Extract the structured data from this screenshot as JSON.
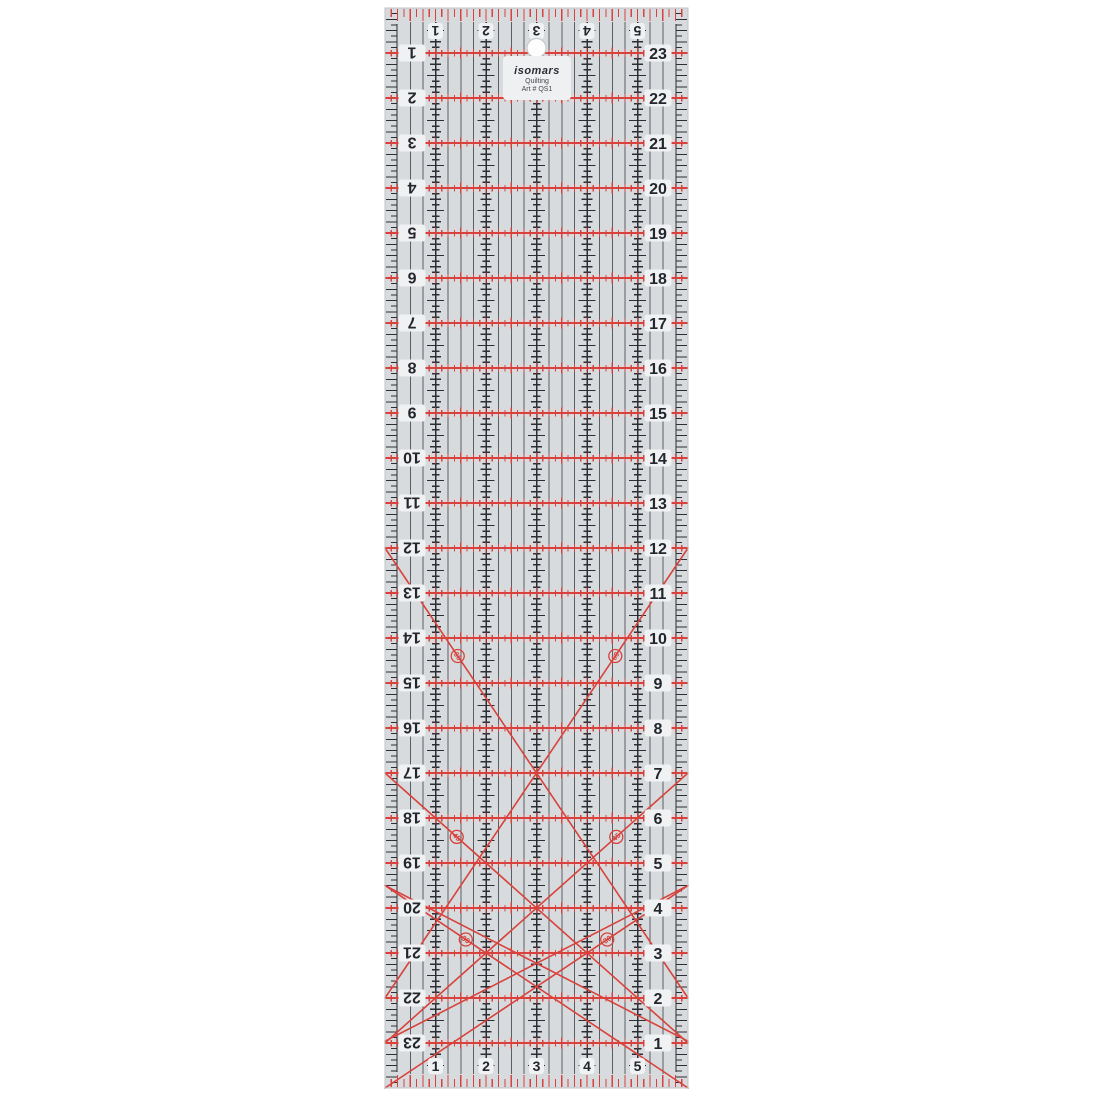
{
  "product": {
    "brand": "isomars",
    "line1": "Quilting",
    "line2": "Art # QS1"
  },
  "ruler": {
    "width_inches": 6,
    "length_inches": 24,
    "scales": {
      "top": [
        "1",
        "2",
        "3",
        "4",
        "5"
      ],
      "bottom": [
        "5",
        "4",
        "3",
        "2",
        "1"
      ],
      "left": [
        "1",
        "2",
        "3",
        "4",
        "5",
        "6",
        "7",
        "8",
        "9",
        "10",
        "11",
        "12",
        "13",
        "14",
        "15",
        "16",
        "17",
        "18",
        "19",
        "20",
        "21",
        "22",
        "23"
      ],
      "right": [
        "23",
        "22",
        "21",
        "20",
        "19",
        "18",
        "17",
        "16",
        "15",
        "14",
        "13",
        "12",
        "11",
        "10",
        "9",
        "8",
        "7",
        "6",
        "5",
        "4",
        "3",
        "2",
        "1"
      ]
    },
    "angle_labels": [
      "60",
      "45",
      "30"
    ],
    "colors": {
      "page_bg": "#ffffff",
      "body": "#d8dbdd",
      "grid_black": "#2b2e34",
      "grid_light": "#5a5e64",
      "red": "#d9423c",
      "halo": "#eff1f2",
      "number": "#23262c",
      "edge": "#bfc3c6",
      "hole_fill": "#fdfdfd",
      "hole_ring": "#c7cacd"
    },
    "geometry": {
      "left": 385,
      "top": 8,
      "ppi_x": 50.5,
      "ppi_y": 45
    },
    "diagonals": [
      {
        "angle": "60",
        "a": [
          0,
          12
        ],
        "b": [
          6,
          22
        ]
      },
      {
        "angle": "60",
        "a": [
          6,
          12
        ],
        "b": [
          0,
          22
        ]
      },
      {
        "angle": "45",
        "a": [
          0,
          17
        ],
        "b": [
          6,
          23
        ]
      },
      {
        "angle": "45",
        "a": [
          6,
          17
        ],
        "b": [
          0,
          23
        ]
      },
      {
        "angle": "30",
        "a": [
          0,
          19.5
        ],
        "b": [
          6,
          22.96
        ]
      },
      {
        "angle": "30",
        "a": [
          6,
          19.5
        ],
        "b": [
          0,
          22.96
        ]
      },
      {
        "angle": "30",
        "a": [
          0,
          19.5
        ],
        "b": [
          6,
          24
        ]
      },
      {
        "angle": "30",
        "a": [
          6,
          19.5
        ],
        "b": [
          0,
          24
        ]
      }
    ],
    "angle_markers": [
      {
        "label": "60",
        "x": 1.44,
        "y": 14.4,
        "rot": 56
      },
      {
        "label": "60",
        "x": 4.56,
        "y": 14.4,
        "rot": -56
      },
      {
        "label": "45",
        "x": 1.42,
        "y": 18.42,
        "rot": 42
      },
      {
        "label": "45",
        "x": 4.58,
        "y": 18.42,
        "rot": -42
      },
      {
        "label": "30",
        "x": 1.6,
        "y": 20.7,
        "rot": 34
      },
      {
        "label": "30",
        "x": 4.4,
        "y": 20.7,
        "rot": -34
      }
    ],
    "hole": {
      "x_in": 3,
      "y_px": 48,
      "r": 9.5
    }
  }
}
